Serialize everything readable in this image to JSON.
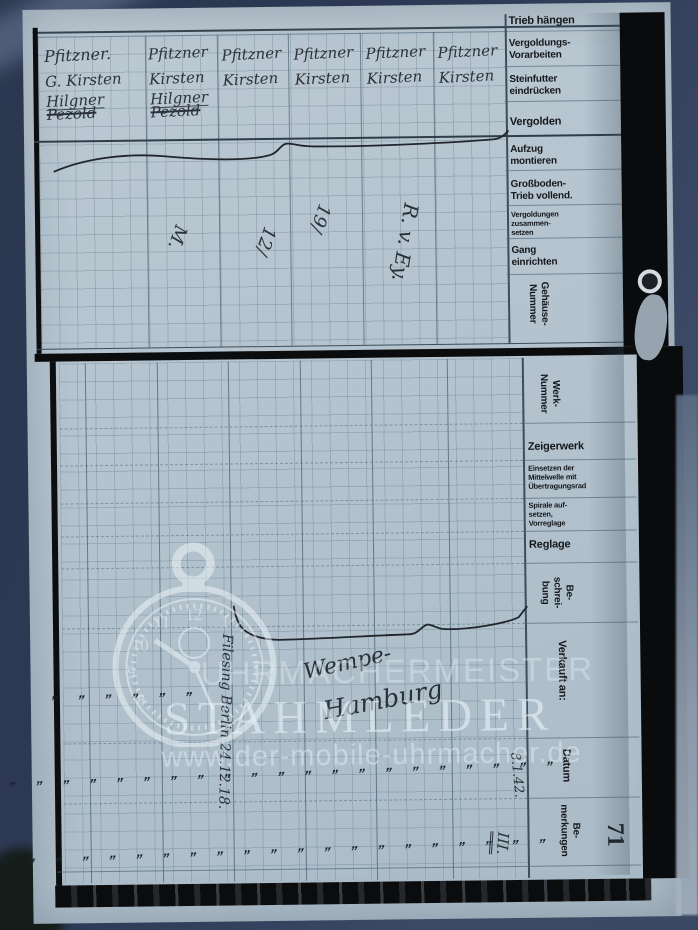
{
  "photo": {
    "background_color": "#2e3a56",
    "page_color": "#b5c4cf",
    "print_ink_color": "#15181c",
    "handwriting_color": "#2a3038",
    "watermark_color": "#edf4fa"
  },
  "watermark": {
    "brand_top": "UHRMACHERMEISTER",
    "brand_main": "STAHMLEDER",
    "brand_url": "www.der-mobile-uhrmacher.de",
    "logo": "pocket-watch-icon"
  },
  "page_number": "71",
  "top_section": {
    "header_note": "Trieb hängen",
    "labels": [
      "Vergoldungs-\nVorarbeiten",
      "Steinfutter\neindrücken",
      "Vergolden",
      "Aufzug\nmontieren",
      "Großboden-\nTrieb vollend.",
      "Vergoldungen\nzusammen-\nsetzen",
      "Gang\neinrichten",
      "Gehäuse-\nNummer"
    ],
    "worker_columns": [
      {
        "entries": [
          "Pfitzner.",
          "G. Kirsten",
          "Hilgner",
          "Pezold"
        ]
      },
      {
        "entries": [
          "Pfitzner",
          "Kirsten",
          "Hilgner",
          "Pezold"
        ]
      },
      {
        "entries": [
          "Pfitzner",
          "Kirsten"
        ]
      },
      {
        "entries": [
          "Pfitzner",
          "Kirsten"
        ]
      },
      {
        "entries": [
          "Pfitzner",
          "Kirsten"
        ]
      },
      {
        "entries": [
          "Pfitzner",
          "Kirsten"
        ]
      }
    ],
    "annotations": [
      "M.",
      "12/",
      "19/",
      "R. v. Ey."
    ]
  },
  "bottom_section": {
    "labels": [
      "Werk-\nNummer",
      "Zeigerwerk",
      "Einsetzen der\nMittelwelle mit\nÜbertragungsrad",
      "Spirale auf-\nsetzen,\nVorreglage",
      "Reglage",
      "Be-\nschrei-\nbung",
      "Verkauft an:",
      "Datum",
      "Be-\nmerkungen"
    ],
    "annotations": {
      "note_vertical": "Filesing Berlin 24.12.18.",
      "customer_line1": "Wempe-",
      "customer_line2": "Hamburg",
      "date": "8.1.42.",
      "remark": "III.",
      "ditto_row_short": "„ „ „ „ „ „",
      "ditto_row_long1": "„ „ „ „ „ „ „ „ „ „ „ „ „ „ „ „ „ „ „ „ „ „",
      "ditto_row_long2": "„ „ „ „ „ „ „ „ „ „ „ „ „ „ „ „ „ „ „ „ „"
    }
  }
}
